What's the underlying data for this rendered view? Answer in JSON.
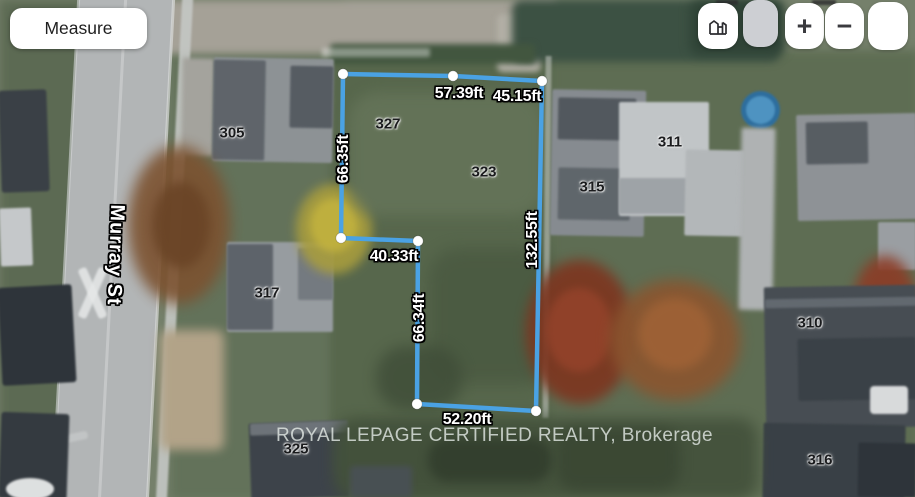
{
  "controls": {
    "measure_label": "Measure",
    "zoom_in_label": "+",
    "zoom_out_label": "−",
    "icons": {
      "buildings": "city-buildings-3d",
      "zoom_in": "plus",
      "zoom_out": "minus"
    }
  },
  "map": {
    "street_label": "Murray St",
    "watermark": "ROYAL LEPAGE CERTIFIED REALTY, Brokerage",
    "line_color": "#4aa2e4",
    "vertex_color": "#ffffff",
    "polygon": {
      "vertices": [
        [
          343,
          74
        ],
        [
          453,
          76
        ],
        [
          542,
          81
        ],
        [
          536,
          411
        ],
        [
          417,
          404
        ],
        [
          418,
          241
        ],
        [
          341,
          238
        ]
      ]
    },
    "measurements": [
      {
        "label": "57.39ft",
        "x": 459,
        "y": 94,
        "rotate": 0
      },
      {
        "label": "45.15ft",
        "x": 517,
        "y": 97,
        "rotate": 0
      },
      {
        "label": "66.35ft",
        "x": 344,
        "y": 159,
        "rotate": -90
      },
      {
        "label": "40.33ft",
        "x": 394,
        "y": 257,
        "rotate": 0
      },
      {
        "label": "66.34ft",
        "x": 420,
        "y": 318,
        "rotate": -90
      },
      {
        "label": "132.55ft",
        "x": 533,
        "y": 240,
        "rotate": -90
      },
      {
        "label": "52.20ft",
        "x": 467,
        "y": 420,
        "rotate": 0
      }
    ],
    "house_numbers": [
      {
        "label": "305",
        "x": 232,
        "y": 133
      },
      {
        "label": "327",
        "x": 388,
        "y": 124
      },
      {
        "label": "323",
        "x": 484,
        "y": 172
      },
      {
        "label": "311",
        "x": 670,
        "y": 142
      },
      {
        "label": "315",
        "x": 592,
        "y": 187
      },
      {
        "label": "317",
        "x": 267,
        "y": 293
      },
      {
        "label": "310",
        "x": 810,
        "y": 323
      },
      {
        "label": "316",
        "x": 820,
        "y": 460
      },
      {
        "label": "325",
        "x": 296,
        "y": 449
      }
    ]
  }
}
